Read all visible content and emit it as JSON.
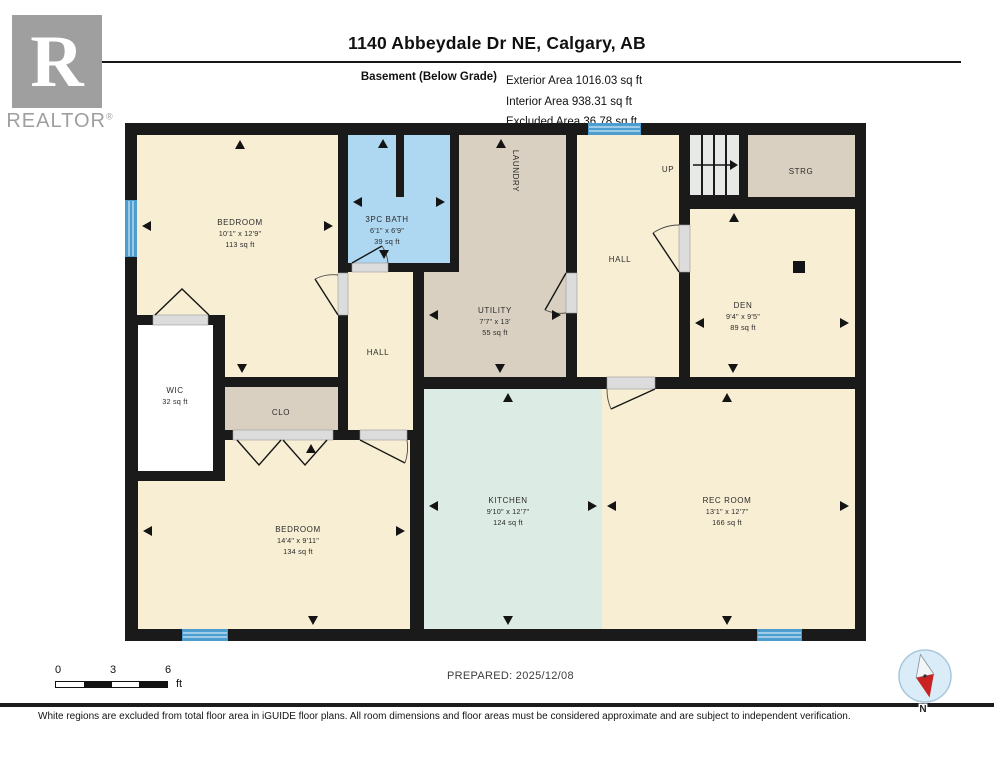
{
  "header": {
    "title": "1140 Abbeydale Dr NE, Calgary, AB",
    "floor_label": "Basement (Below Grade)",
    "areas": [
      "Exterior Area 1016.03 sq ft",
      "Interior Area 938.31 sq ft",
      "Excluded Area 36.78 sq ft"
    ],
    "logo": {
      "letter": "R",
      "brand": "REALTOR",
      "registered": "®"
    }
  },
  "plan": {
    "rooms": {
      "bedroom1": {
        "name": "BEDROOM",
        "dims": "10'1\" x 12'9\"",
        "area": "113 sq ft"
      },
      "bath": {
        "name": "3PC BATH",
        "dims": "6'1\" x 6'9\"",
        "area": "39 sq ft"
      },
      "laundry": {
        "name": "LAUNDRY"
      },
      "utility": {
        "name": "UTILITY",
        "dims": "7'7\" x 13'",
        "area": "55 sq ft"
      },
      "hall_center": {
        "name": "HALL"
      },
      "hall_top": {
        "name": "HALL"
      },
      "stairs": {
        "name": "UP"
      },
      "strg": {
        "name": "STRG"
      },
      "den": {
        "name": "DEN",
        "dims": "9'4\" x 9'5\"",
        "area": "89 sq ft"
      },
      "wic": {
        "name": "WIC",
        "area": "32 sq ft"
      },
      "clo": {
        "name": "CLO"
      },
      "bedroom2": {
        "name": "BEDROOM",
        "dims": "14'4\" x 9'11\"",
        "area": "134 sq ft"
      },
      "kitchen": {
        "name": "KITCHEN",
        "dims": "9'10\" x 12'7\"",
        "area": "124 sq ft"
      },
      "rec": {
        "name": "REC ROOM",
        "dims": "13'1\" x 12'7\"",
        "area": "166 sq ft"
      }
    },
    "colors": {
      "wall": "#1a1a1a",
      "room_cream": "#f8eed3",
      "room_tan": "#d9d0c1",
      "room_blue": "#aed7f1",
      "room_teal": "#dcebe3",
      "stairs": "#e6e9e6",
      "excluded_white": "#ffffff",
      "window_blue": "#4d9ecf",
      "door_gray": "#dcdcdc",
      "compass_red": "#c92222"
    }
  },
  "footer": {
    "scale": {
      "ticks": [
        "0",
        "3",
        "6"
      ],
      "unit": "ft"
    },
    "prepared": "PREPARED: 2025/12/08",
    "compass_label": "N",
    "disclaimer": "White regions are excluded from total floor area in iGUIDE floor plans. All room dimensions and floor areas must be considered approximate and are subject to independent verification."
  }
}
